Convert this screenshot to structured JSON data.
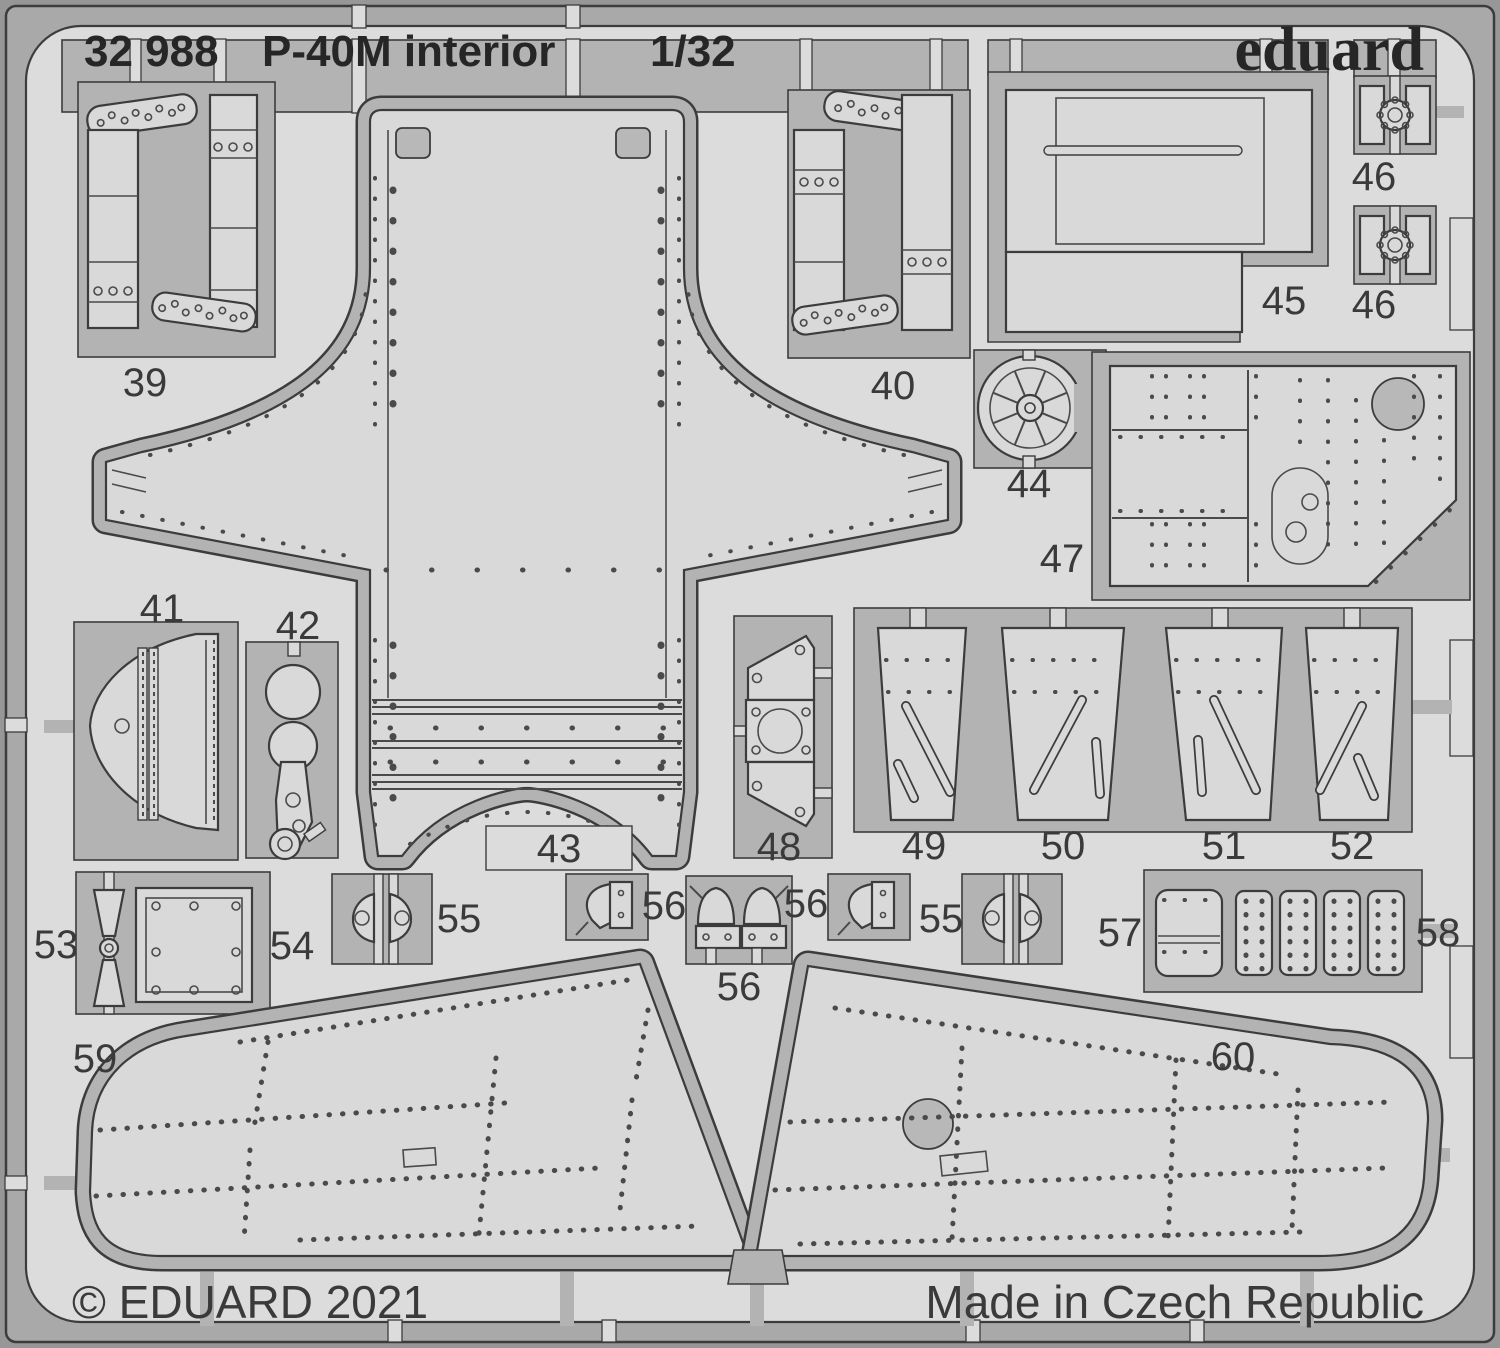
{
  "header": {
    "catalog_number": "32 988",
    "product_name": "P-40M interior",
    "scale": "1/32",
    "brand": "eduard"
  },
  "footer": {
    "copyright": "© EDUARD 2021",
    "made_in": "Made in Czech Republic"
  },
  "colors": {
    "outer": "#979797",
    "band": "#a9a9a9",
    "sheet": "#dcdcdc",
    "waste": "#b3b3b3",
    "part": "#d9d9d9",
    "hole": "#b8b8b8",
    "line": "#3c3c3c",
    "line2": "#4a4a4a",
    "ink": "#262626",
    "ink2": "#3a3a3a"
  },
  "parts": {
    "p39": {
      "label": "39"
    },
    "p40": {
      "label": "40"
    },
    "p41": {
      "label": "41"
    },
    "p42": {
      "label": "42"
    },
    "p43": {
      "label": "43"
    },
    "p44": {
      "label": "44"
    },
    "p45": {
      "label": "45"
    },
    "p46a": {
      "label": "46"
    },
    "p46b": {
      "label": "46"
    },
    "p47": {
      "label": "47"
    },
    "p48": {
      "label": "48"
    },
    "p49": {
      "label": "49"
    },
    "p50": {
      "label": "50"
    },
    "p51": {
      "label": "51"
    },
    "p52": {
      "label": "52"
    },
    "p53": {
      "label": "53"
    },
    "p54": {
      "label": "54"
    },
    "p55a": {
      "label": "55"
    },
    "p55b": {
      "label": "55"
    },
    "p56a": {
      "label": "56"
    },
    "p56b": {
      "label": "56"
    },
    "p56c": {
      "label": "56"
    },
    "p57": {
      "label": "57"
    },
    "p58": {
      "label": "58"
    },
    "p59": {
      "label": "59"
    },
    "p60": {
      "label": "60"
    }
  }
}
